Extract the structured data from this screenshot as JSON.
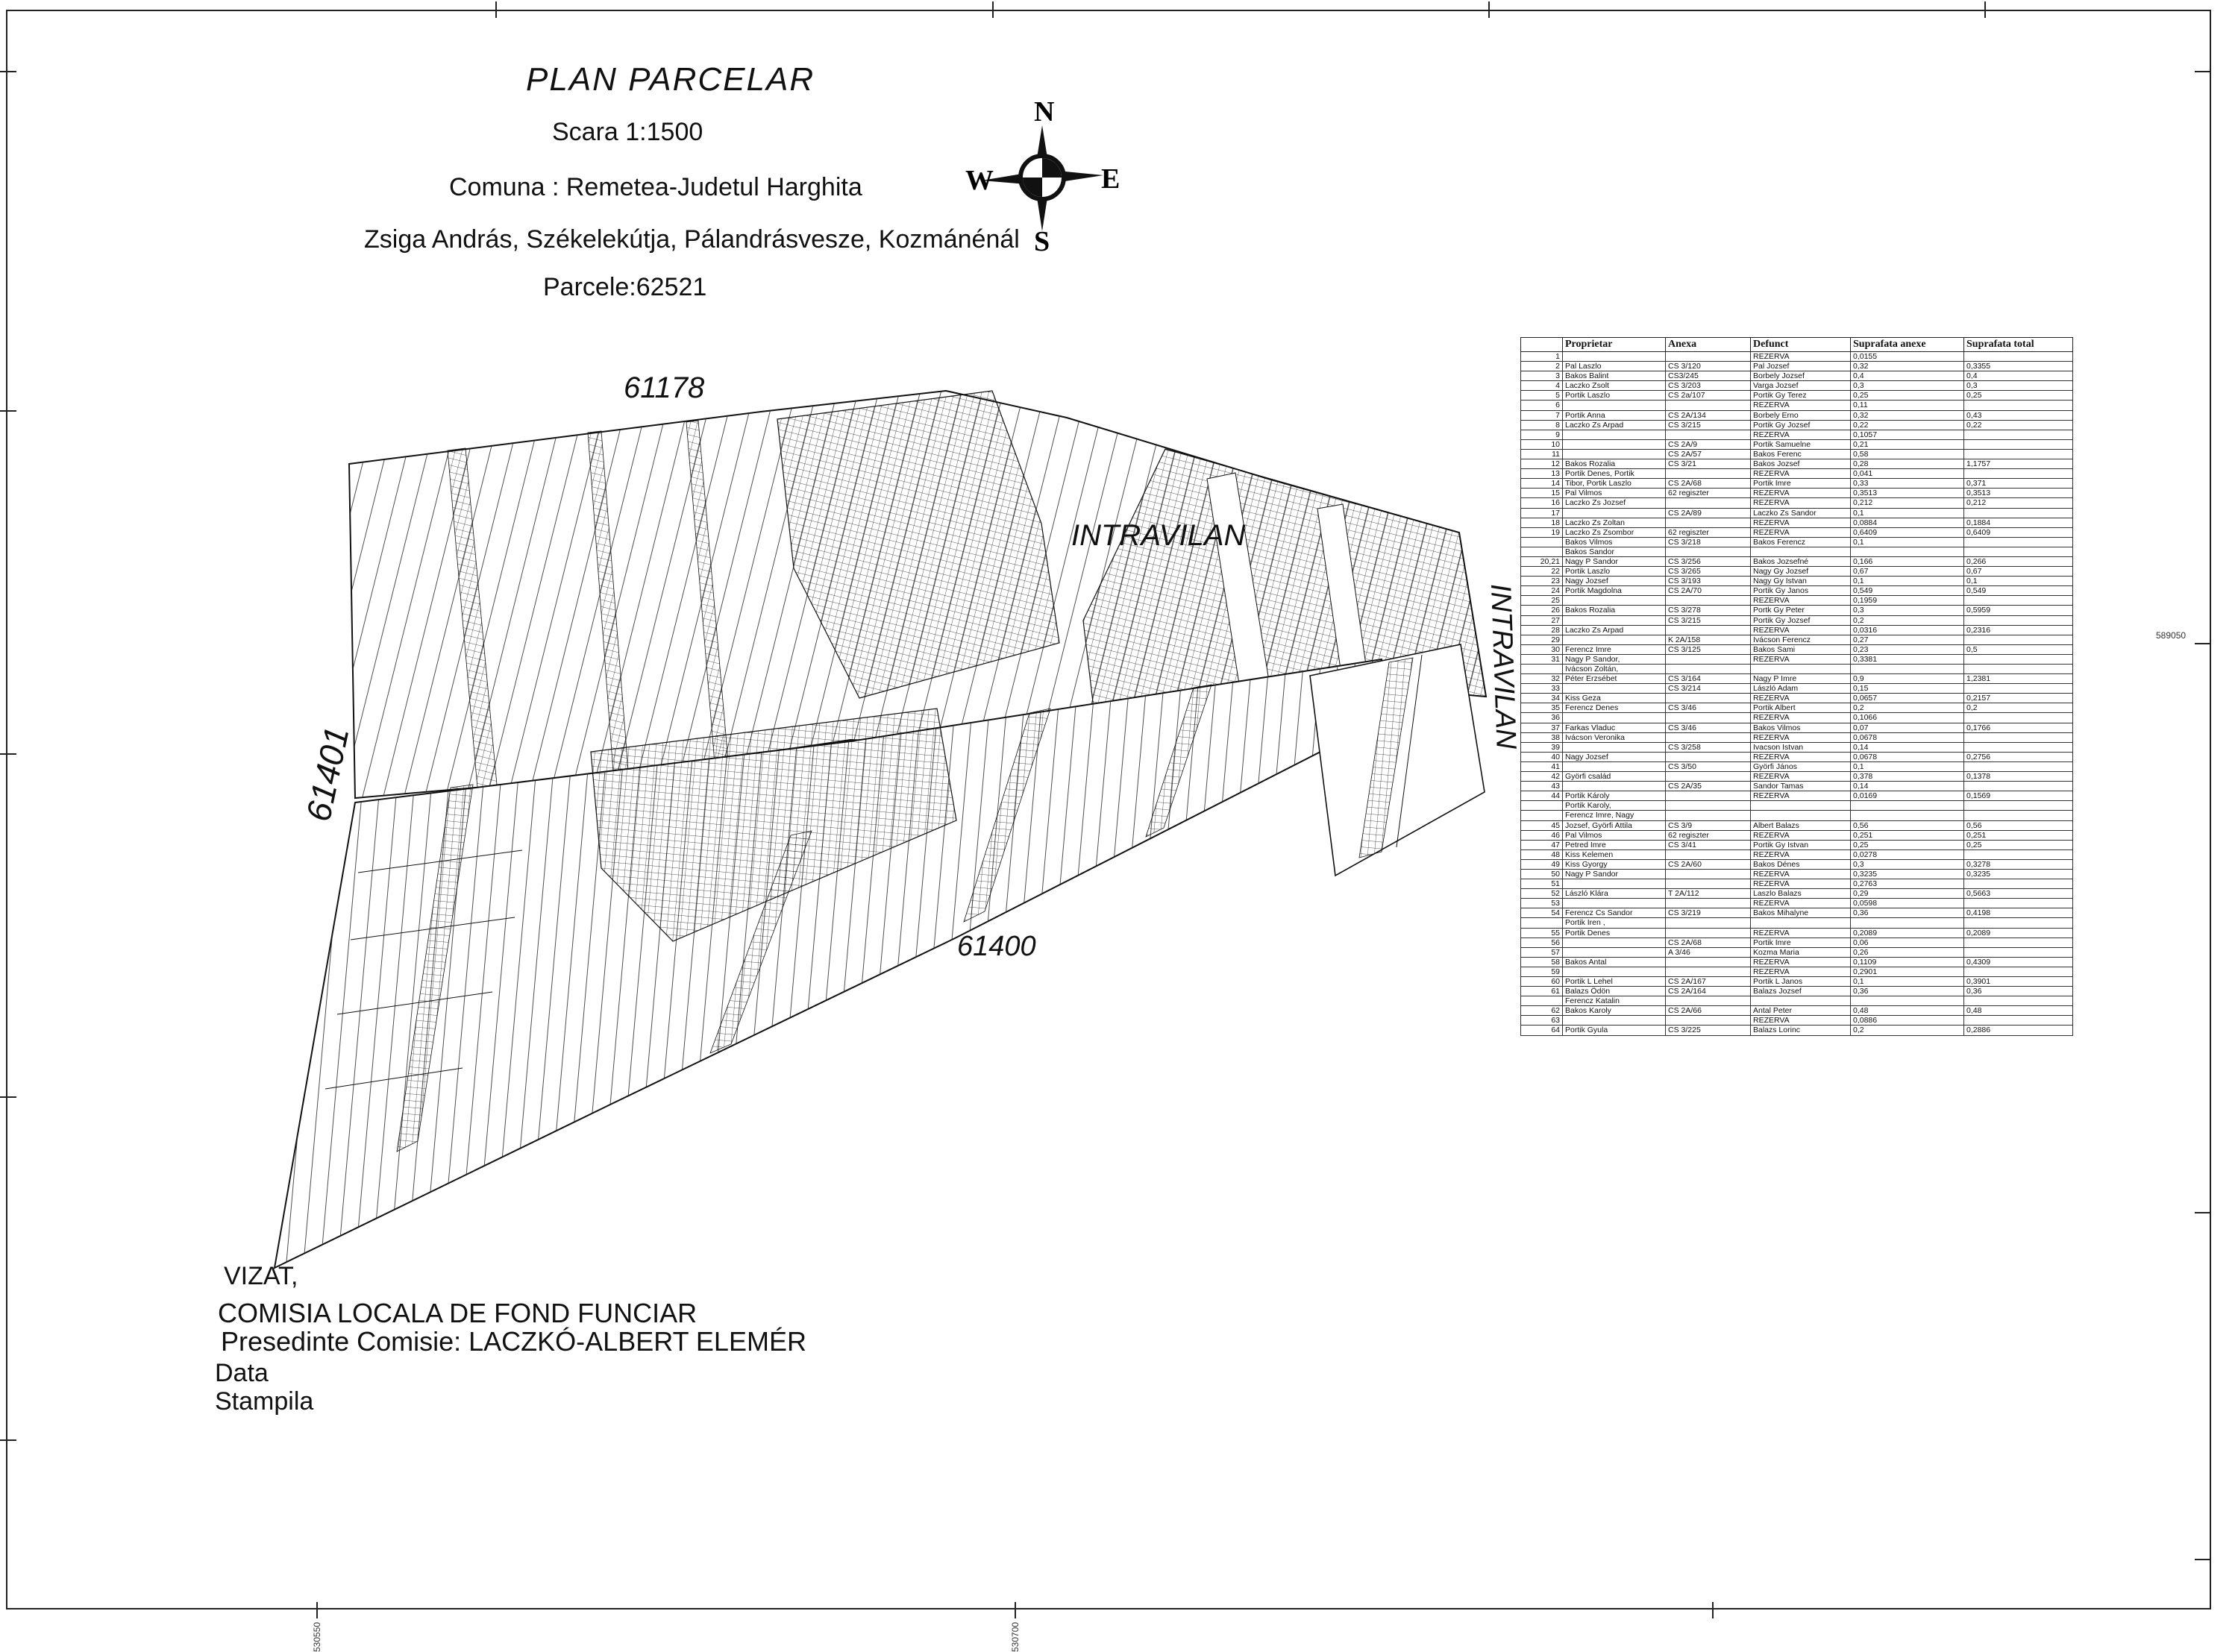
{
  "page": {
    "title": "PLAN PARCELAR",
    "scale": "Scara 1:1500",
    "commune": "Comuna : Remetea-Judetul Harghita",
    "owners_line": "Zsiga András, Székelekútja, Pálandrásvesze, Kozmánénál",
    "parcel_line": "Parcele:62521"
  },
  "compass": {
    "north": "N",
    "south": "S",
    "east": "E",
    "west": "W"
  },
  "map": {
    "labels": {
      "road_top": "61178",
      "road_left": "61401",
      "road_bottom": "61400",
      "intravilan_center": "INTRAVILAN",
      "intravilan_right": "INTRAVILAN"
    }
  },
  "frame_ticks": {
    "bottom_1": "530550",
    "bottom_2": "530700",
    "right_1": "589050"
  },
  "table": {
    "headers": [
      "",
      "Proprietar",
      "Anexa",
      "Defunct",
      "Suprafata anexe",
      "Suprafata total"
    ],
    "rows": [
      [
        "1",
        "",
        "",
        "REZERVA",
        "0,0155",
        ""
      ],
      [
        "2",
        "Pal Laszlo",
        "CS 3/120",
        "Pal Jozsef",
        "0,32",
        "0,3355"
      ],
      [
        "3",
        "Bakos Balint",
        "CS3/245",
        "Borbely Jozsef",
        "0,4",
        "0,4"
      ],
      [
        "4",
        "Laczko Zsolt",
        "CS 3/203",
        "Varga Jozsef",
        "0,3",
        "0,3"
      ],
      [
        "5",
        "Portik Laszlo",
        "CS 2a/107",
        "Portik Gy Terez",
        "0,25",
        "0,25"
      ],
      [
        "6",
        "",
        "",
        "REZERVA",
        "0,11",
        ""
      ],
      [
        "7",
        "Portik Anna",
        "CS 2A/134",
        "Borbely Erno",
        "0,32",
        "0,43"
      ],
      [
        "8",
        "Laczko Zs Arpad",
        "CS 3/215",
        "Portik Gy Jozsef",
        "0,22",
        "0,22"
      ],
      [
        "9",
        "",
        "",
        "REZERVA",
        "0,1057",
        ""
      ],
      [
        "10",
        "",
        "CS 2A/9",
        "Portik Samuelne",
        "0,21",
        ""
      ],
      [
        "11",
        "",
        "CS 2A/57",
        "Bakos Ferenc",
        "0,58",
        ""
      ],
      [
        "12",
        "Bakos Rozalia",
        "CS 3/21",
        "Bakos Jozsef",
        "0,28",
        "1,1757"
      ],
      [
        "13",
        "Portik Denes, Portik",
        "",
        "REZERVA",
        "0,041",
        ""
      ],
      [
        "14",
        "Tibor, Portik Laszlo",
        "CS 2A/68",
        "Portik Imre",
        "0,33",
        "0,371"
      ],
      [
        "15",
        "Pal Vilmos",
        "62 regiszter",
        "REZERVA",
        "0,3513",
        "0,3513"
      ],
      [
        "16",
        "Laczko Zs Jozsef",
        "",
        "REZERVA",
        "0,212",
        "0,212"
      ],
      [
        "17",
        "",
        "CS 2A/89",
        "Laczko Zs Sandor",
        "0,1",
        ""
      ],
      [
        "18",
        "Laczko Zs Zoltan",
        "",
        "REZERVA",
        "0,0884",
        "0,1884"
      ],
      [
        "19",
        "Laczko Zs Zsombor",
        "62 regiszter",
        "REZERVA",
        "0,6409",
        "0,6409"
      ],
      [
        "",
        "Bakos Vilmos",
        "CS 3/218",
        "Bakos Ferencz",
        "0,1",
        ""
      ],
      [
        "",
        "Bakos Sandor",
        "",
        "",
        "",
        ""
      ],
      [
        "20,21",
        "Nagy P Sandor",
        "CS 3/256",
        "Bakos Jozsefné",
        "0,166",
        "0,266"
      ],
      [
        "22",
        "Portik Laszlo",
        "CS 3/265",
        "Nagy Gy Jozsef",
        "0,67",
        "0,67"
      ],
      [
        "23",
        "Nagy Jozsef",
        "CS 3/193",
        "Nagy Gy Istvan",
        "0,1",
        "0,1"
      ],
      [
        "24",
        "Portik Magdolna",
        "CS 2A/70",
        "Portik Gy Janos",
        "0,549",
        "0,549"
      ],
      [
        "25",
        "",
        "",
        "REZERVA",
        "0,1959",
        ""
      ],
      [
        "26",
        "Bakos Rozalia",
        "CS 3/278",
        "Portk Gy Peter",
        "0,3",
        "0,5959"
      ],
      [
        "27",
        "",
        "CS 3/215",
        "Portik Gy Jozsef",
        "0,2",
        ""
      ],
      [
        "28",
        "Laczko Zs Arpad",
        "",
        "REZERVA",
        "0,0316",
        "0,2316"
      ],
      [
        "29",
        "",
        "K 2A/158",
        "Ivácson Ferencz",
        "0,27",
        ""
      ],
      [
        "30",
        "Ferencz Imre",
        "CS 3/125",
        "Bakos Sami",
        "0,23",
        "0,5"
      ],
      [
        "31",
        "Nagy P Sandor,",
        "",
        "REZERVA",
        "0,3381",
        ""
      ],
      [
        "",
        "Ivácson Zoltán,",
        "",
        "",
        "",
        ""
      ],
      [
        "32",
        "Péter Erzsébet",
        "CS 3/164",
        "Nagy P Imre",
        "0,9",
        "1,2381"
      ],
      [
        "33",
        "",
        "CS 3/214",
        "László Adam",
        "0,15",
        ""
      ],
      [
        "34",
        "Kiss Geza",
        "",
        "REZERVA",
        "0,0657",
        "0,2157"
      ],
      [
        "35",
        "Ferencz Denes",
        "CS 3/46",
        "Portik Albert",
        "0,2",
        "0,2"
      ],
      [
        "36",
        "",
        "",
        "REZERVA",
        "0,1066",
        ""
      ],
      [
        "37",
        "Farkas Vladuc",
        "CS 3/46",
        "Bakos Vilmos",
        "0,07",
        "0,1766"
      ],
      [
        "38",
        "Ivácson Veronika",
        "",
        "REZERVA",
        "0,0678",
        ""
      ],
      [
        "39",
        "",
        "CS 3/258",
        "Ivacson Istvan",
        "0,14",
        ""
      ],
      [
        "40",
        "Nagy Jozsef",
        "",
        "REZERVA",
        "0,0678",
        "0,2756"
      ],
      [
        "41",
        "",
        "CS 3/50",
        "Györfi János",
        "0,1",
        ""
      ],
      [
        "42",
        "Györfi család",
        "",
        "REZERVA",
        "0,378",
        "0,1378"
      ],
      [
        "43",
        "",
        "CS 2A/35",
        "Sandor Tamas",
        "0,14",
        ""
      ],
      [
        "44",
        "Portik Károly",
        "",
        "REZERVA",
        "0,0169",
        "0,1569"
      ],
      [
        "",
        "Portik Karoly,",
        "",
        "",
        "",
        ""
      ],
      [
        "",
        "Ferencz Imre, Nagy",
        "",
        "",
        "",
        ""
      ],
      [
        "45",
        "Jozsef, Györfi Attila",
        "CS 3/9",
        "Albert Balazs",
        "0,56",
        "0,56"
      ],
      [
        "46",
        "Pal Vilmos",
        "62 regiszter",
        "REZERVA",
        "0,251",
        "0,251"
      ],
      [
        "47",
        "Petred Imre",
        "CS 3/41",
        "Portik Gy Istvan",
        "0,25",
        "0,25"
      ],
      [
        "48",
        "Kiss Kelemen",
        "",
        "REZERVA",
        "0,0278",
        ""
      ],
      [
        "49",
        "Kiss Gyorgy",
        "CS 2A/60",
        "Bakos Dénes",
        "0,3",
        "0,3278"
      ],
      [
        "50",
        "Nagy P Sandor",
        "",
        "REZERVA",
        "0,3235",
        "0,3235"
      ],
      [
        "51",
        "",
        "",
        "REZERVA",
        "0,2763",
        ""
      ],
      [
        "52",
        "László Klára",
        "T 2A/112",
        "Laszlo Balazs",
        "0,29",
        "0,5663"
      ],
      [
        "53",
        "",
        "",
        "REZERVA",
        "0,0598",
        ""
      ],
      [
        "54",
        "Ferencz Cs Sandor",
        "CS 3/219",
        "Bakos Mihalyne",
        "0,36",
        "0,4198"
      ],
      [
        "",
        "Portik Iren ,",
        "",
        "",
        "",
        ""
      ],
      [
        "55",
        "Portik Denes",
        "",
        "REZERVA",
        "0,2089",
        "0,2089"
      ],
      [
        "56",
        "",
        "CS 2A/68",
        "Portik Imre",
        "0,06",
        ""
      ],
      [
        "57",
        "",
        "A 3/46",
        "Kozma Maria",
        "0,26",
        ""
      ],
      [
        "58",
        "Bakos Antal",
        "",
        "REZERVA",
        "0,1109",
        "0,4309"
      ],
      [
        "59",
        "",
        "",
        "REZERVA",
        "0,2901",
        ""
      ],
      [
        "60",
        "Portik L Lehel",
        "CS 2A/167",
        "Portik L Janos",
        "0,1",
        "0,3901"
      ],
      [
        "61",
        "Balazs Ödön",
        "CS 2A/164",
        "Balazs Jozsef",
        "0,36",
        "0,36"
      ],
      [
        "",
        "Ferencz Katalin",
        "",
        "",
        "",
        ""
      ],
      [
        "62",
        "Bakos Karoly",
        "CS 2A/66",
        "Antal Peter",
        "0,48",
        "0,48"
      ],
      [
        "63",
        "",
        "",
        "REZERVA",
        "0,0886",
        ""
      ],
      [
        "64",
        "Portik Gyula",
        "CS 3/225",
        "Balazs Lorinc",
        "0,2",
        "0,2886"
      ]
    ]
  },
  "footer": {
    "vizat": "VIZAT,",
    "comisia": "COMISIA LOCALA DE FOND FUNCIAR",
    "presedinte": "Presedinte Comisie: LACZKÓ-ALBERT ELEMÉR",
    "data_label": "Data",
    "stampila": "Stampila"
  }
}
